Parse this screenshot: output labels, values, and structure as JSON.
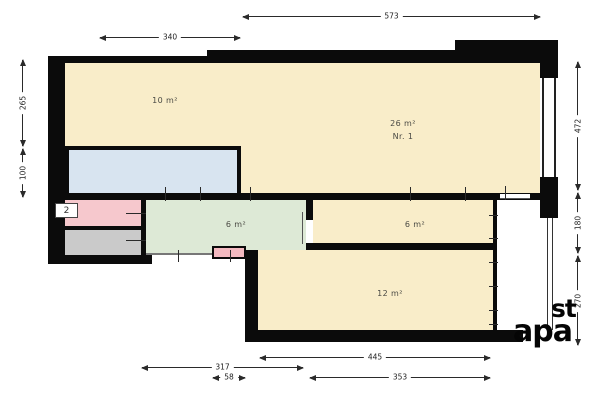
{
  "plan": {
    "unit_badge": "2",
    "rooms": {
      "room10": {
        "label": "10 m²",
        "color": "#f9edc9"
      },
      "room26": {
        "label": "26 m²",
        "number": "Nr. 1",
        "color": "#f9edc9"
      },
      "hall6": {
        "label": "6 m²",
        "color": "#dde9d6"
      },
      "room6": {
        "label": "6 m²",
        "color": "#f9edc9"
      },
      "room12": {
        "label": "12 m²",
        "color": "#f9edc9"
      },
      "blue_room": {
        "color": "#d8e4f0"
      },
      "pink_room": {
        "color": "#f6c8cd"
      },
      "small_pink_box": {
        "color": "#f3b9c0"
      },
      "gray_room": {
        "color": "#cacaca"
      }
    },
    "dimensions": {
      "top_573": "573",
      "top_340": "340",
      "left_265": "265",
      "left_100": "100",
      "right_472": "472",
      "right_180": "180",
      "right_270": "270",
      "bottom_445": "445",
      "bottom_317": "317",
      "bottom_58": "58",
      "bottom_353": "353"
    },
    "watermark": {
      "line1": "st",
      "line2": "apa"
    },
    "wall_color": "#0b0b0b"
  }
}
